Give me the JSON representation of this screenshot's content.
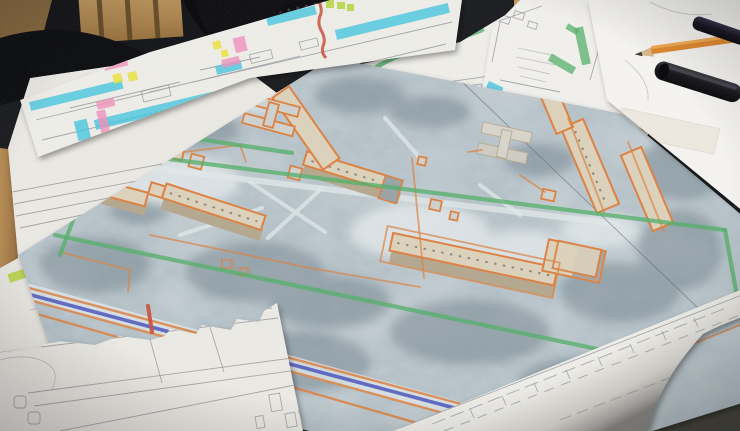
{
  "scene": {
    "setting": "Desk covered with urban planning documents photographed at an angle",
    "objects": [
      {
        "name": "aerial-photo-print",
        "desc": "large tilted grayscale aerial photograph of an apartment district, buildings traced in orange marker, green site-boundary lines, blue road line flanked by orange"
      },
      {
        "name": "plan-strip-sheet",
        "desc": "long narrow plan drawing at top-left highlighted with cyan, pink and yellow marker bars and a red wavy line"
      },
      {
        "name": "plan-sheet-wavy-lines",
        "desc": "pencil plan sheet with a green wavy line, a cyan wavy line and a lime line over building footprints"
      },
      {
        "name": "plan-sheet-green-bars",
        "desc": "steeply tilted plan sheet with short green highlighter bars and pencil notes"
      },
      {
        "name": "elevation-sheet-left",
        "desc": "pencil drawing sheet on the left with a lime highlight bar"
      },
      {
        "name": "site-plan-sheet-bottom",
        "desc": "white site-plan sheet with pencil road lines and footprints overlapping the photo's bottom edge"
      },
      {
        "name": "rolled-drawing-sheet",
        "desc": "curled sheet bottom-right with stepped building-footprint pencil outlines"
      },
      {
        "name": "blank-sheet-top-right",
        "desc": "bright white sheet holding the markers and pencil"
      },
      {
        "name": "black-marker",
        "desc": "large black chisel marker"
      },
      {
        "name": "black-marker-on-pencil",
        "desc": "smaller black marker lying across the orange pencil"
      },
      {
        "name": "orange-pencil",
        "desc": "sharpened orange pencil"
      },
      {
        "name": "office-chair",
        "desc": "black office chair with perforated backrest, top-left"
      },
      {
        "name": "blue-cloth",
        "desc": "blue garment draped near the chair"
      },
      {
        "name": "desk",
        "desc": "light wooden desk surface visible at edges"
      },
      {
        "name": "carpet",
        "desc": "dark olive carpet floor visible at bottom-right corner"
      }
    ]
  },
  "palette": {
    "bg_dark": "#191a1d",
    "paper": "#f0efeb",
    "paper_dim": "#e3e1db",
    "pencil": "#8f8f96",
    "marker_orange": "#dd8142",
    "marker_green": "#55b06a",
    "marker_cyan": "#45c6de",
    "marker_pink": "#f191bb",
    "marker_yellow": "#ece23f",
    "marker_lime": "#b4d43e",
    "marker_blue": "#4a55bd",
    "marker_red": "#c8503a",
    "photo_base": "#c9d2d6",
    "photo_tree": "#77868e",
    "building_roof": "#dcd2bc",
    "building_side": "#b4a88f",
    "wood": "#b08550",
    "wood_dark": "#7a5a33",
    "carpet": "#434233",
    "chair": "#0d0d10",
    "cloth_blue": "#2e5a7d"
  }
}
